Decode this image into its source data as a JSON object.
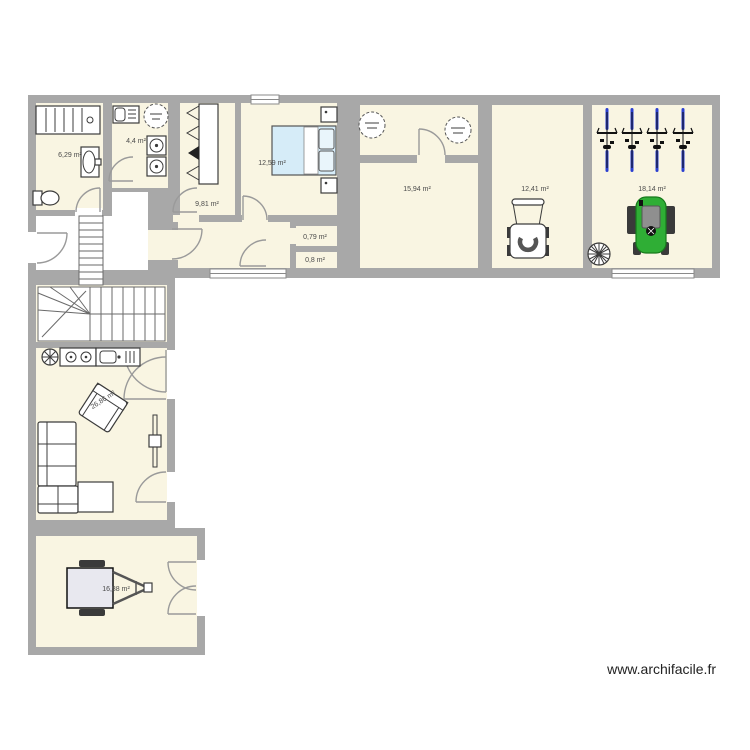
{
  "watermark": "www.archifacile.fr",
  "colors": {
    "wall": "#a8a8a8",
    "floor": "#f9f5e2",
    "bed": "#d6ecf8",
    "pillow": "#e9f5fb",
    "tractor": "#2fae35",
    "bike": "#2b3fd0",
    "label": "#4a4a4a"
  },
  "rooms": {
    "bathroom": {
      "area": "6,29 m²"
    },
    "laundry": {
      "area": "4,4 m²"
    },
    "dressing": {
      "area": "9,81 m²"
    },
    "bedroom": {
      "area": "12,59 m²"
    },
    "hall": {
      "area": "15,94 m²"
    },
    "storage": {
      "area": "12,41 m²"
    },
    "bike_garage": {
      "area": "18,14 m²"
    },
    "wc": {
      "area": "0,79 m²"
    },
    "closet": {
      "area": "0,8 m²"
    },
    "living": {
      "area": "26,86 m²"
    },
    "garage": {
      "area": "16,88 m²"
    }
  }
}
